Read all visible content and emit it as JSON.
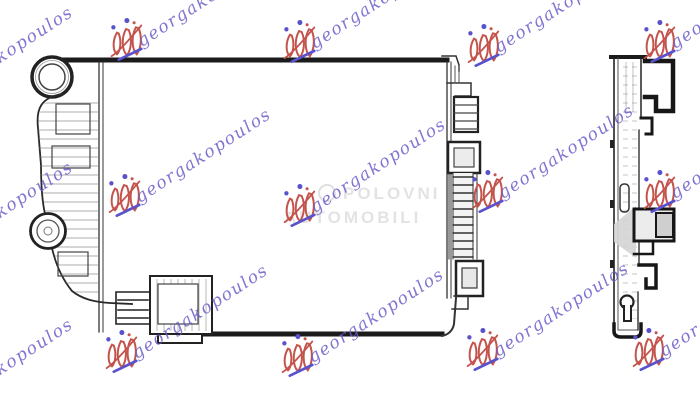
{
  "page": {
    "background": "#ffffff",
    "description": "Technical line drawing of an automotive radiator shown in front view and side profile view, overlaid with seller watermarks"
  },
  "drawing": {
    "line_color": "#1b1b1b",
    "thin_line_color": "#333333",
    "shade_color": "#d4d4d4",
    "views": [
      {
        "id": "front-view",
        "label": "radiator front view"
      },
      {
        "id": "side-view",
        "label": "radiator side profile view"
      }
    ],
    "features": [
      "filler-neck",
      "inlet-flange",
      "left-tank-ribs",
      "drain-connector",
      "upper-bracket",
      "outlet-connector",
      "mounting-bracket-top",
      "mounting-bracket-mid",
      "retainer-hooks",
      "keyhole-slot"
    ]
  },
  "watermarks": {
    "brand": {
      "text": "georgakopoulos",
      "text_color": "#6a5ec9",
      "logo_red": "#c4534b",
      "dot_color": "#5a52cc",
      "underline_color": "#5a52cc"
    },
    "center": {
      "line1": "POLOVNI",
      "line2": "AUTOMOBILI",
      "color": "#e3e3e3"
    }
  }
}
